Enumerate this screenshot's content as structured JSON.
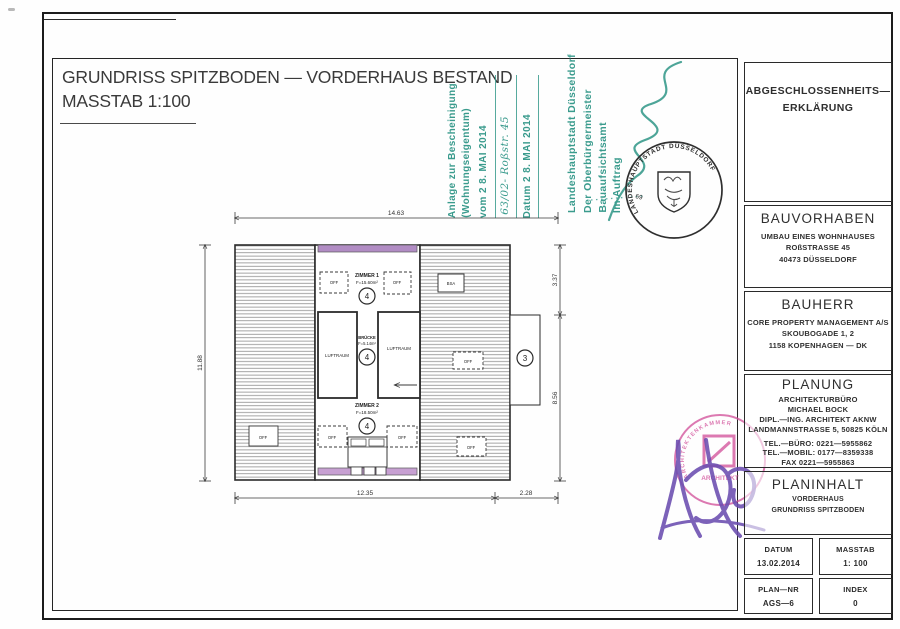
{
  "title": {
    "line1": "GRUNDRISS SPITZBODEN — VORDERHAUS BESTAND",
    "line2": "MASSTAB 1:100"
  },
  "approval_stamp": {
    "attachment_line1": "Anlage zur Bescheinigung",
    "attachment_line2": "(Wohnungseigentum)",
    "vom_line": "vom   2 8. MAI 2014",
    "file_ref": "63/02- Roßstr. 45",
    "datum_line": "Datum   2 8. MAI 2014",
    "authority_line1": "Landeshauptstadt Düsseldorf",
    "authority_line2": "Der Oberbürgermeister",
    "authority_line3": "Bauaufsichtsamt",
    "authority_line4": "Im Auftrag"
  },
  "city_seal": {
    "ring_text": "LANDESHAUPTSTADT DÜSSELDORF",
    "number": "69"
  },
  "architect_seal": {
    "ring_text": "ARCHITEKTENKAMMER",
    "label": "ARCHITEKT"
  },
  "plan": {
    "dim_top": "14.63",
    "dim_left": "11.88",
    "dim_right_upper": "3.37",
    "dim_right_lower": "8.56",
    "dim_bottom_main": "12.35",
    "dim_bottom_right": "2.28",
    "zimmer1_name": "ZIMMER 1",
    "zimmer1_area": "F=15.60m²",
    "zimmer2_name": "ZIMMER 2",
    "zimmer2_area": "F=18.50m²",
    "bruecke_name": "BRÜCKE",
    "bruecke_area": "F=5.14m²",
    "luftraum": "LUFTRAUM",
    "bsa": "BSA",
    "off": "OFF",
    "unit4": "4",
    "unit3": "3"
  },
  "titleblock": {
    "erklaerung": {
      "line1": "ABGESCHLOSSENHEITS—",
      "line2": "ERKLÄRUNG"
    },
    "bauvorhaben": {
      "title": "BAUVORHABEN",
      "lines": [
        "UMBAU EINES WOHNHAUSES",
        "ROßSTRASSE 45",
        "40473 DÜSSELDORF"
      ]
    },
    "bauherr": {
      "title": "BAUHERR",
      "lines": [
        "CORE PROPERTY MANAGEMENT A/S",
        "SKOUBOGADE 1, 2",
        "1158 KOPENHAGEN — DK"
      ]
    },
    "planung": {
      "title": "PLANUNG",
      "lines": [
        "ARCHITEKTURBÜRO",
        "MICHAEL BOCK",
        "DIPL.—ING. ARCHITEKT AKNW",
        "LANDMANNSTRASSE 5, 50825 KÖLN"
      ],
      "contact": [
        "TEL.—BÜRO: 0221—5955862",
        "TEL.—MOBIL: 0177—8359338",
        "FAX 0221—5955863"
      ]
    },
    "planinhalt": {
      "title": "PLANINHALT",
      "lines": [
        "VORDERHAUS",
        "GRUNDRISS SPITZBODEN"
      ]
    },
    "datum": {
      "label": "DATUM",
      "value": "13.02.2014"
    },
    "masstab": {
      "label": "MASSTAB",
      "value": "1: 100"
    },
    "plannr": {
      "label": "PLAN—NR",
      "value": "AGS—6"
    },
    "index": {
      "label": "INDEX",
      "value": "0"
    }
  },
  "colors": {
    "stamp_green": "#3a9b8d",
    "stamp_pink": "#d4589f",
    "signature_violet": "#6b4db0",
    "wall_purple_top": "#b18cc4",
    "wall_purple_bottom": "#c7a0d2",
    "line": "#2b2b2b"
  }
}
